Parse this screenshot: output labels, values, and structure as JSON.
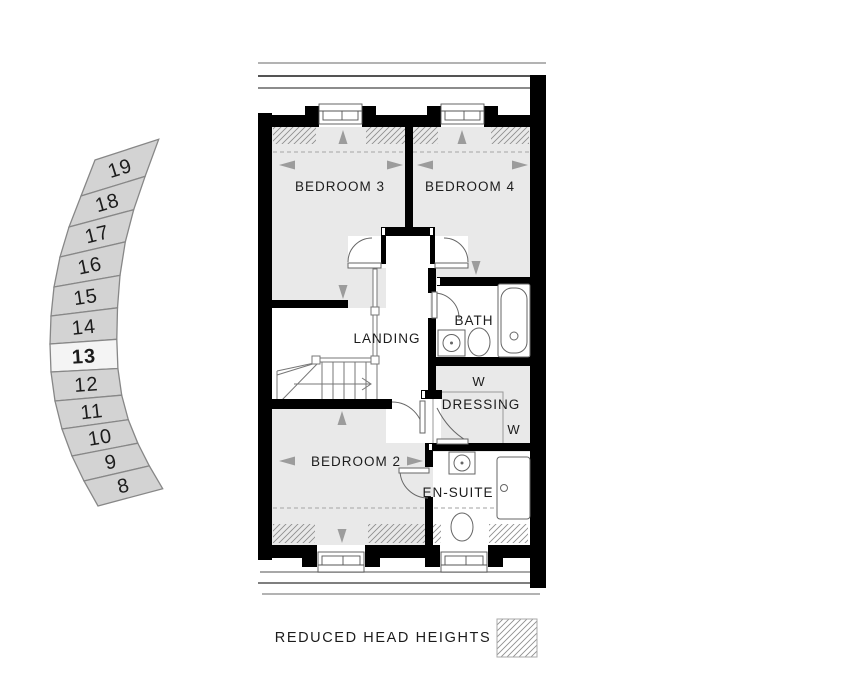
{
  "locator": {
    "plots": [
      "19",
      "18",
      "17",
      "16",
      "15",
      "14",
      "13",
      "12",
      "11",
      "10",
      "9",
      "8"
    ],
    "highlighted_plot": "13",
    "cell_color": "#d3d3d3",
    "highlight_color": "#f4f4f4",
    "border_color": "#878787",
    "number_color": "#ffffff",
    "highlight_number_color": "#000000"
  },
  "rooms": {
    "bedroom3": "BEDROOM 3",
    "bedroom4": "BEDROOM 4",
    "landing": "LANDING",
    "bath": "BATH",
    "dressing": "DRESSING",
    "wardrobe": "W",
    "bedroom2": "BEDROOM 2",
    "ensuite": "EN-SUITE"
  },
  "legend": {
    "reduced_head_heights": "REDUCED HEAD HEIGHTS"
  },
  "colors": {
    "wall": "#000000",
    "floor": "#e9e9e9",
    "hatch": "#8f8f8f",
    "dashed": "#b3b3b3",
    "arrow": "#9c9c9c",
    "thin_line": "#666666",
    "eave_gray": "#9a9a9a",
    "eave_dark": "#3c3c3c"
  }
}
